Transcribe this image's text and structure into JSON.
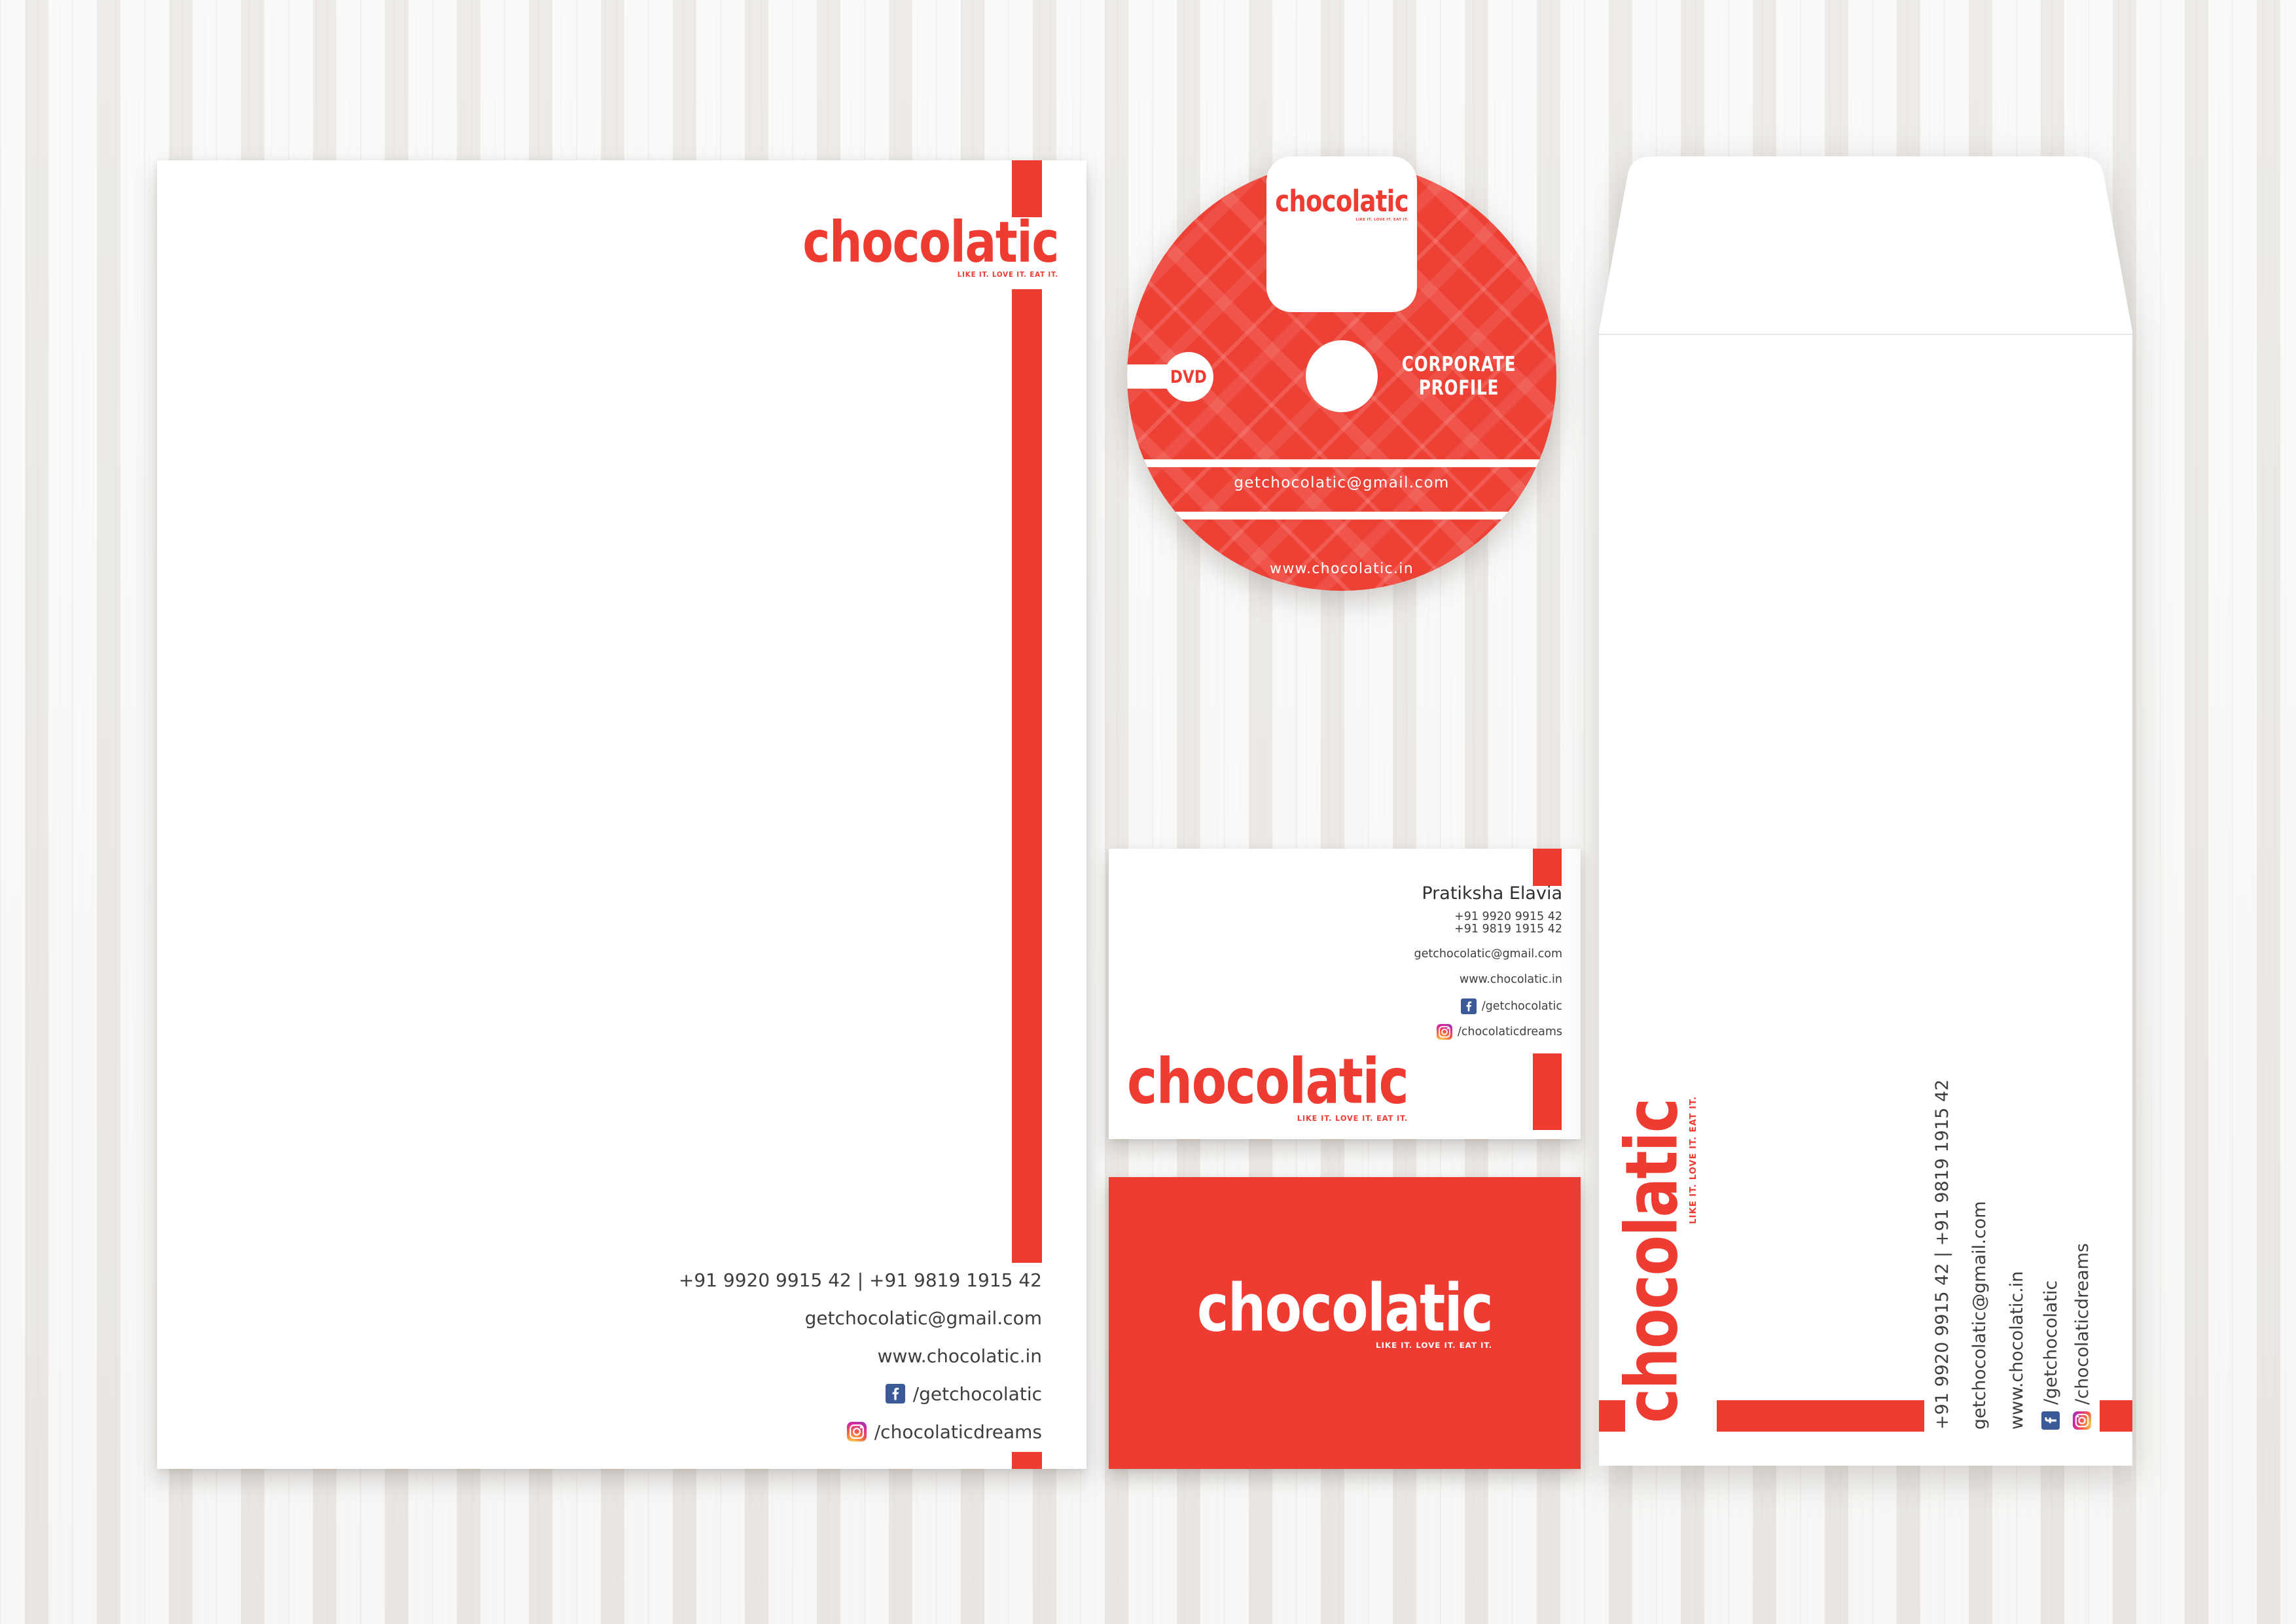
{
  "brand": {
    "name": "chocolatic",
    "tagline": "LIKE IT. LOVE IT. EAT IT."
  },
  "contact": {
    "phones_line": "+91 9920 9915 42 | +91 9819 1915 42",
    "phone1": "+91 9920 9915 42",
    "phone2": "+91 9819 1915 42",
    "email": "getchocolatic@gmail.com",
    "website": "www.chocolatic.in",
    "facebook": "/getchocolatic",
    "instagram": "/chocolaticdreams"
  },
  "dvd": {
    "format_label": "DVD",
    "title_line1": "CORPORATE",
    "title_line2": "PROFILE",
    "email": "getchocolatic@gmail.com",
    "website": "www.chocolatic.in"
  },
  "business_card": {
    "person_name": "Pratiksha Elavia"
  },
  "colors": {
    "brand_red": "#ee3c33",
    "disc_red": "#ee4136",
    "facebook_blue": "#3a5a98",
    "text_dark": "#3e3e3e"
  },
  "icons": {
    "facebook": "facebook-icon",
    "instagram": "instagram-icon"
  }
}
